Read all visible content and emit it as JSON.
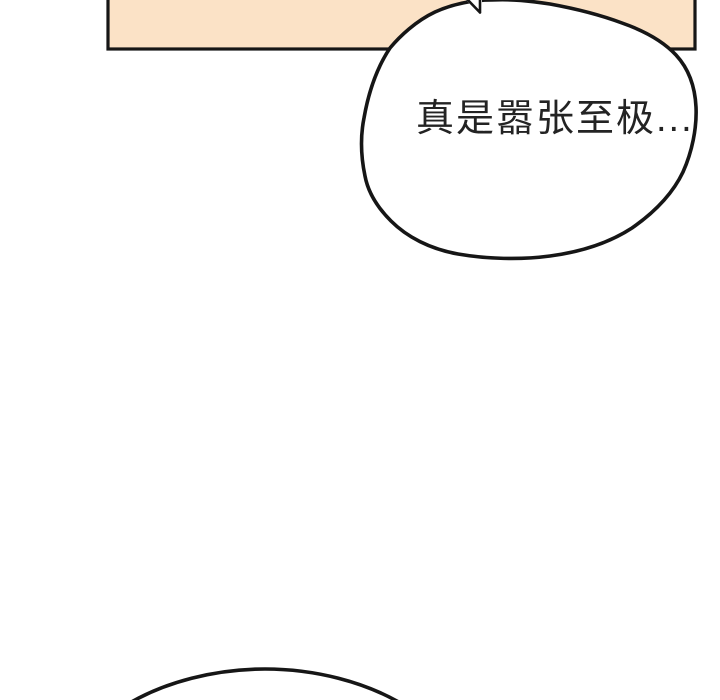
{
  "page": {
    "background_color": "#ffffff",
    "ink_color": "#161616"
  },
  "panel": {
    "fill_color": "#fbe2c6"
  },
  "bubbles": {
    "main": {
      "text": "真是嚣张至极...",
      "fill_color": "#ffffff"
    }
  }
}
